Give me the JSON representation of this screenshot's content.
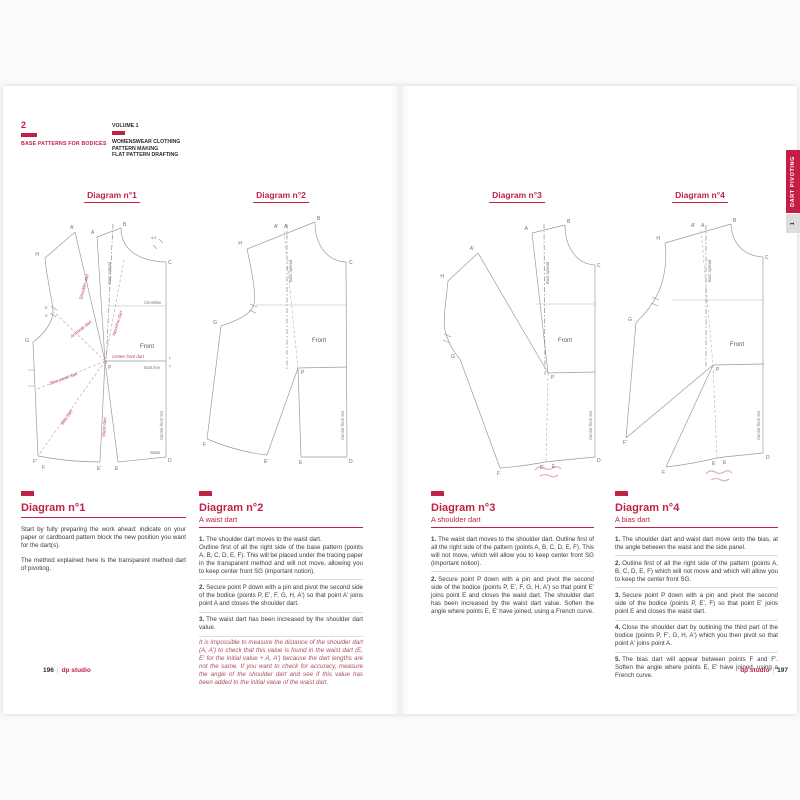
{
  "accent": "#bf2245",
  "header": {
    "chapter_number": "2",
    "chapter_title": "BASE PATTERNS FOR BODICES",
    "volume": "VOLUME 1",
    "series_line1": "WOMENSWEAR CLOTHING",
    "series_line2": "PATTERN MAKING",
    "series_line3": "FLAT PATTERN DRAFTING"
  },
  "side_tab": {
    "label": "DART PIVOTING",
    "number": "1"
  },
  "footer": {
    "left_number": "196",
    "right_number": "197",
    "brand": "dp studio",
    "divider": "|"
  },
  "diagram_titles": [
    "Diagram n°1",
    "Diagram n°2",
    "Diagram n°3",
    "Diagram n°4"
  ],
  "diagrams": {
    "d1": {
      "B": "B",
      "A": "A",
      "Ap": "A'",
      "H": "H",
      "C": "C",
      "G": "G",
      "Kp": "K'",
      "K": "K",
      "L": "L",
      "Lp": "L'",
      "P": "P",
      "Fp": "F'",
      "F": "F",
      "Ep": "E'",
      "E": "E",
      "D": "D",
      "measure": "4.5",
      "bust_spread": "Bust spread",
      "chestline": "Chestline",
      "front": "Front",
      "bust_line": "Bust line",
      "waist": "Waist",
      "centre_front_sg": "Centre front SG",
      "shoulder_dart": "Shoulder dart",
      "neckline_dart": "Neckline dart",
      "armhole_dart": "Armhole dart",
      "center_front_dart": "Center front dart",
      "side_panel_dart": "Side panel dart",
      "bias_dart": "Bias dart",
      "waist_dart": "Waist dart"
    },
    "d2": {
      "B": "B",
      "A": "A",
      "Ap": "A'",
      "H": "H",
      "C": "C",
      "G": "G",
      "P": "P",
      "F": "F",
      "Ep": "E'",
      "E": "E",
      "D": "D",
      "bust_spread": "Bust spread",
      "front": "Front",
      "centre_front_sg": "Centre front SG"
    },
    "d3": {
      "B": "B",
      "A": "A",
      "Ap": "A'",
      "H": "H",
      "C": "C",
      "G": "G",
      "P": "P",
      "F": "F",
      "Ep": "E'",
      "E": "E",
      "D": "D",
      "bust_spread": "Bust spread",
      "front": "Front",
      "centre_front_sg": "Centre front SG"
    },
    "d4": {
      "B": "B",
      "A": "A",
      "Ap": "A'",
      "H": "H",
      "C": "C",
      "G": "G",
      "P": "P",
      "Fp": "F'",
      "F": "F",
      "Ep": "E'",
      "E": "E",
      "D": "D",
      "bust_spread": "Bust spread",
      "front": "Front",
      "centre_front_sg": "Centre front SG"
    }
  },
  "sections": [
    {
      "title": "Diagram n°1",
      "subtitle": "",
      "items": [
        {
          "num": "",
          "text": "Start by fully preparing the work ahead: indicate on your paper or cardboard pattern block the new position you want for the dart(s)."
        },
        {
          "num": "",
          "text": "The method explained here is the transparent method dart of pivoting."
        }
      ],
      "note": ""
    },
    {
      "title": "Diagram n°2",
      "subtitle": "A waist dart",
      "items": [
        {
          "num": "1.",
          "text": "The shoulder dart moves to the waist dart.\nOutline first of all the right side of the base pattern (points A, B, C, D, E, F). This will be placed under the tracing paper in the transparent method and will not move, allowing you to keep center front SG (important notion)."
        },
        {
          "num": "2.",
          "text": "Secure point P down with a pin and pivot the second side of the bodice (points P, E', F, G, H, A') so that point A' joins point A and closes the shoulder dart."
        },
        {
          "num": "3.",
          "text": "The waist dart has been increased by the shoulder dart value."
        }
      ],
      "note": "It is impossible to measure the distance of the shoulder dart (A, A') to check that this value is found in the waist dart (E, E' for the initial value + A, A') because the dart lengths are not the same. If you want to check for accuracy, measure the angle of the shoulder dart and see if this value has been added to the initial value of the waist dart."
    },
    {
      "title": "Diagram n°3",
      "subtitle": "A shoulder dart",
      "items": [
        {
          "num": "1.",
          "text": "The waist dart moves to the shoulder dart. Outline first of all the right side of the pattern (points A, B, C, D, E, F). This will not move, which will allow you to keep center front SG (important notion)."
        },
        {
          "num": "2.",
          "text": "Secure point P down with a pin and pivot the second side of the bodice (points P, E', F, G, H, A') so that point E' joins point E and closes the waist dart. The shoulder dart has been increased by the waist dart value. Soften the angle where points E, E' have joined, using a French curve."
        }
      ],
      "note": ""
    },
    {
      "title": "Diagram n°4",
      "subtitle": "A bias dart",
      "items": [
        {
          "num": "1.",
          "text": "The shoulder dart and waist dart move onto the bias, at the angle between the waist and the side panel."
        },
        {
          "num": "2.",
          "text": "Outline first of all the right side of the pattern (points A, B, C, D, E, F) which will not move and which will allow you to keep the center front SG."
        },
        {
          "num": "3.",
          "text": "Secure point P down with a pin and pivot the second side of the bodice (points P, E', F) so that point E' joins point E and closes the waist dart."
        },
        {
          "num": "4.",
          "text": "Close the shoulder dart by outlining the third part of the bodice (points P, F', G, H, A') which you then pivot so that point A' joins point A."
        },
        {
          "num": "5.",
          "text": "The bias dart will appear between points F and F'. Soften the angle where points E, E' have joined, using a French curve."
        }
      ],
      "note": ""
    }
  ]
}
